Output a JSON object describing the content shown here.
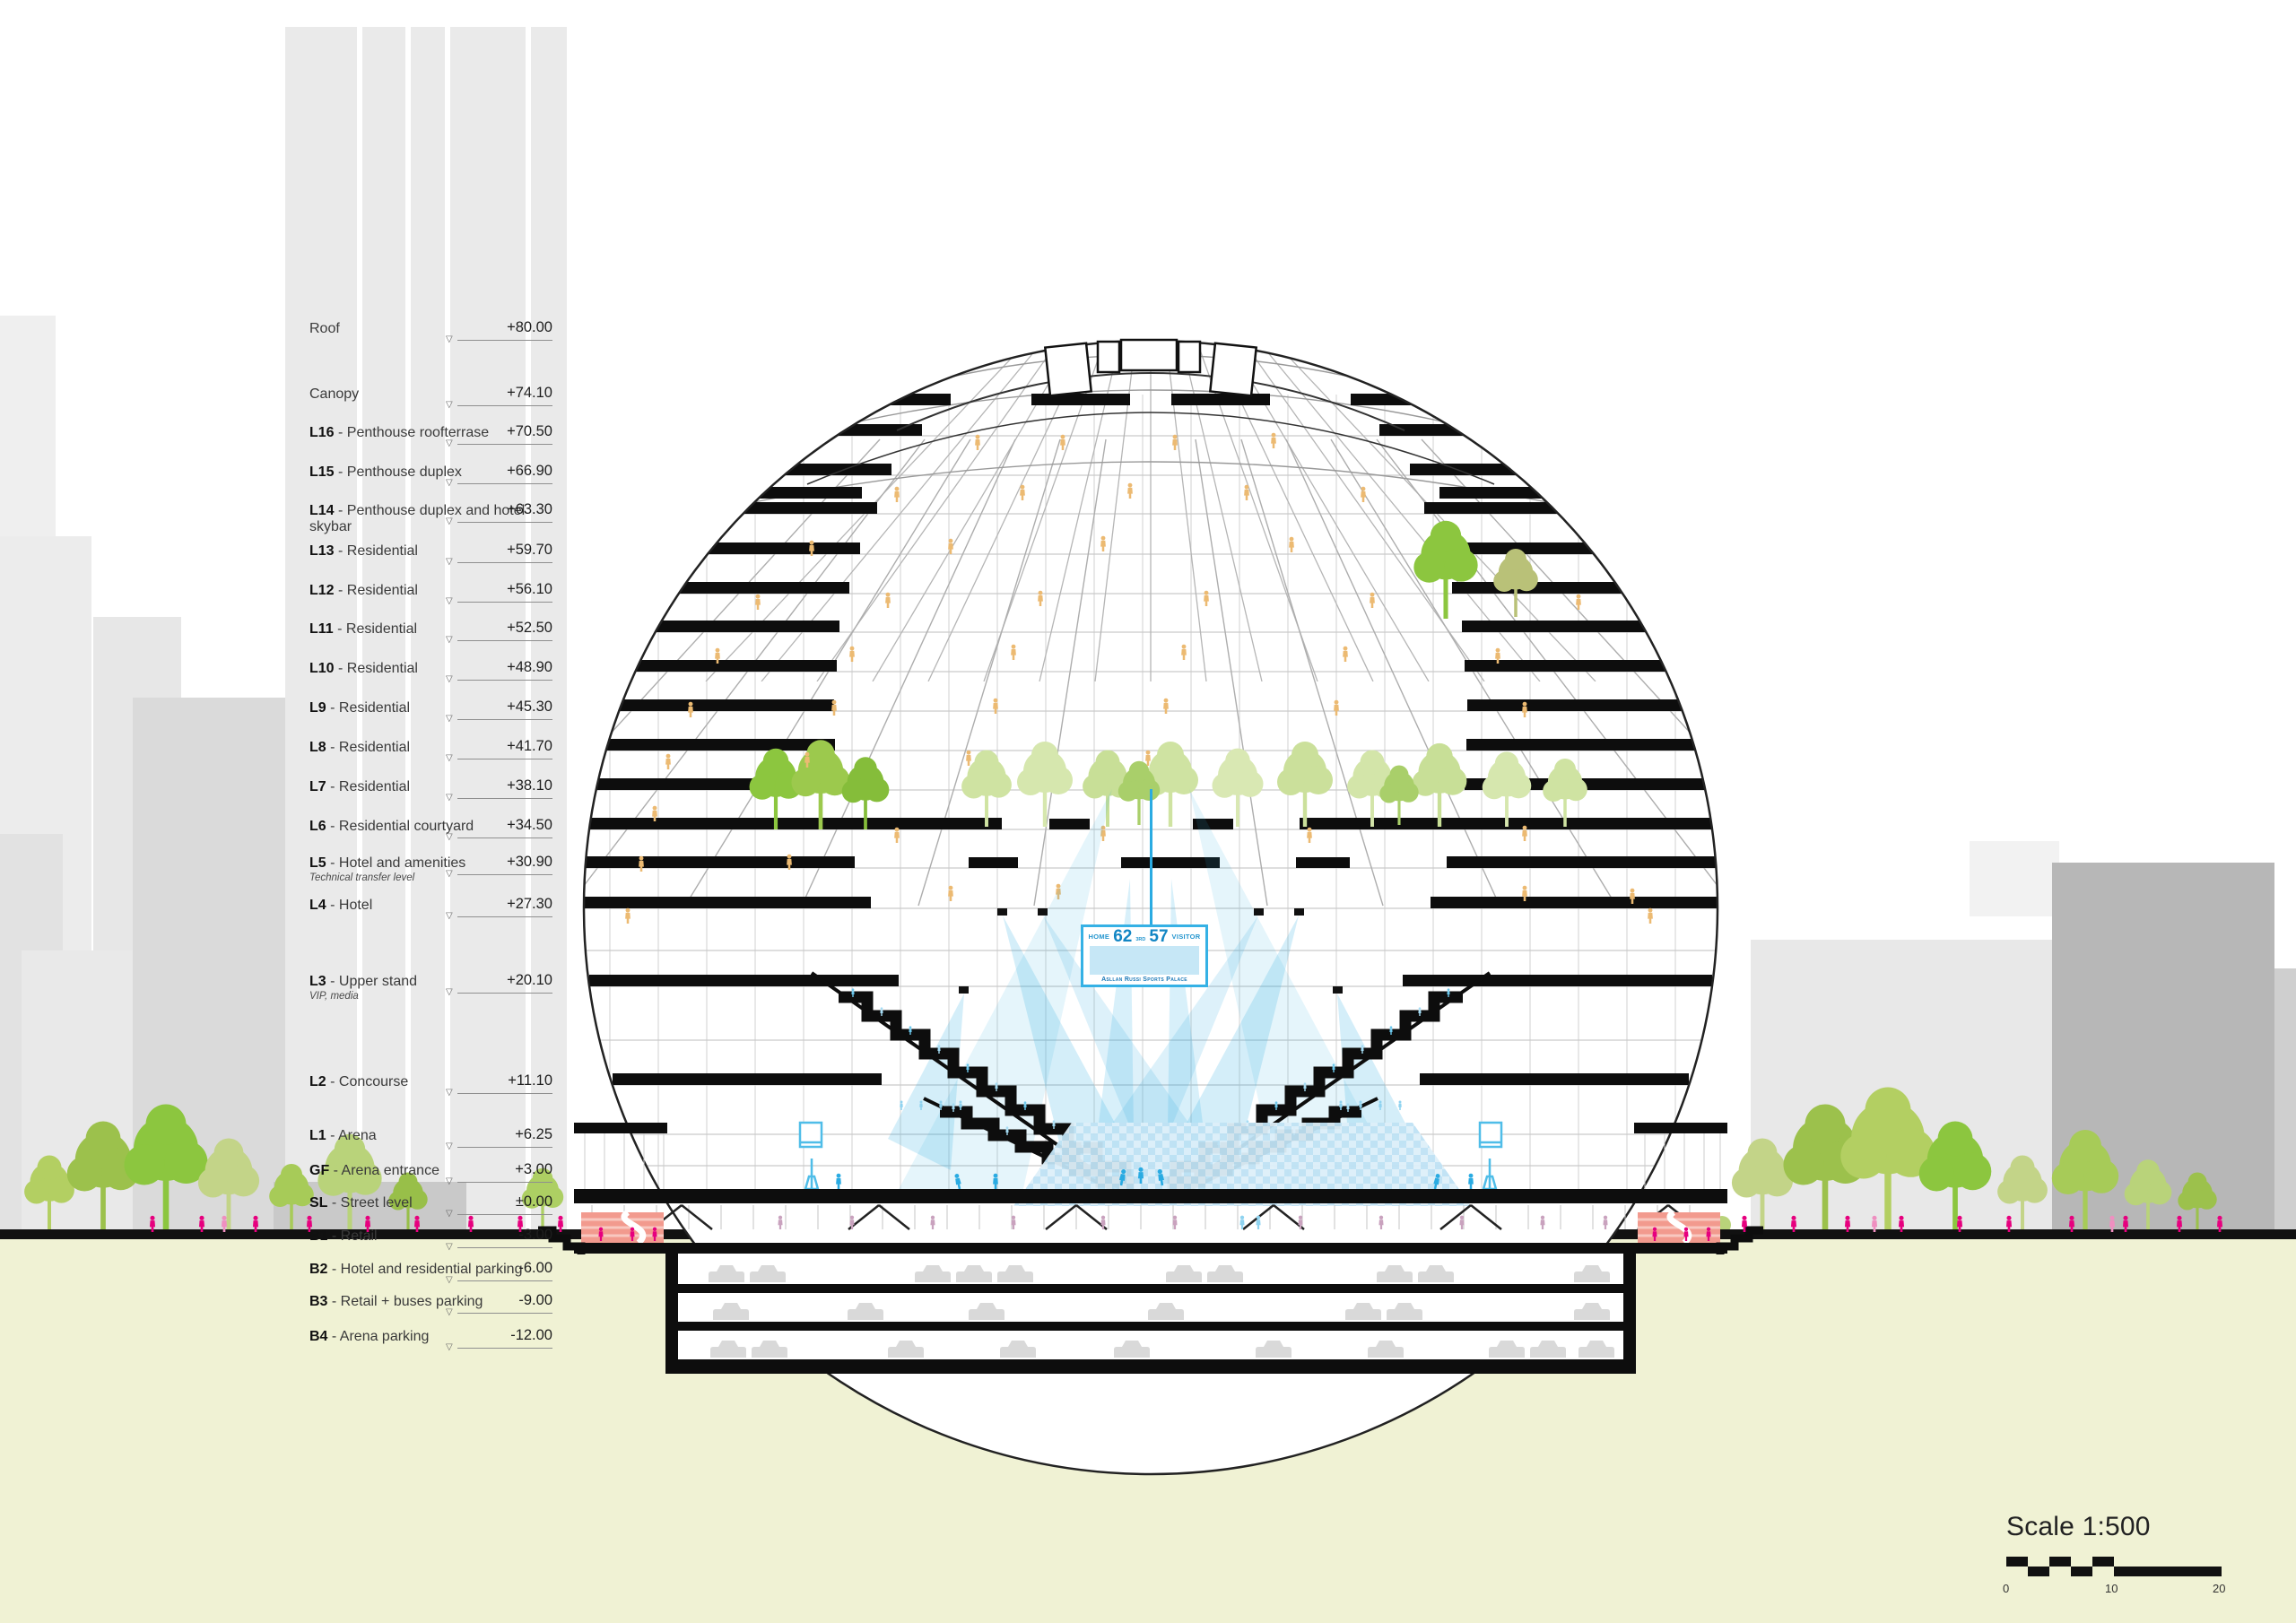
{
  "colors": {
    "accent_blue": "#29abe2",
    "score_blue": "#1386c4",
    "beam_blue": "#bfe4f4",
    "magenta": "#e6007e",
    "tan_people": "#ecba72",
    "tree_green": "#8cc63f",
    "pale_green": "#cfe3a2",
    "ground_yellow": "#f0f2d4",
    "building_gray": "#e9e9e9",
    "dark_building_gray": "#b7b7b7",
    "ramp_salmon": "#f29a8e"
  },
  "levels": [
    {
      "code": "",
      "name": "Roof",
      "value": "+80.00"
    },
    {
      "code": "",
      "name": "Canopy",
      "value": "+74.10"
    },
    {
      "code": "L16",
      "name": " - Penthouse roofterrase",
      "value": "+70.50"
    },
    {
      "code": "L15",
      "name": " - Penthouse duplex",
      "value": "+66.90"
    },
    {
      "code": "L14",
      "name": " - Penthouse duplex and hotel skybar",
      "value": "+63.30"
    },
    {
      "code": "L13",
      "name": " - Residential",
      "value": "+59.70"
    },
    {
      "code": "L12",
      "name": " - Residential",
      "value": "+56.10"
    },
    {
      "code": "L11",
      "name": " - Residential",
      "value": "+52.50"
    },
    {
      "code": "L10",
      "name": " - Residential",
      "value": "+48.90"
    },
    {
      "code": "L9",
      "name": " - Residential",
      "value": "+45.30"
    },
    {
      "code": "L8",
      "name": " - Residential",
      "value": "+41.70"
    },
    {
      "code": "L7",
      "name": " - Residential",
      "value": "+38.10"
    },
    {
      "code": "L6",
      "name": " - Residential courtyard",
      "value": "+34.50"
    },
    {
      "code": "L5",
      "name": " - Hotel and amenities",
      "sub": "Technical transfer level",
      "value": "+30.90"
    },
    {
      "code": "L4",
      "name": " - Hotel",
      "value": "+27.30"
    },
    {
      "code": "L3",
      "name": " - Upper stand",
      "sub": "VIP, media",
      "value": "+20.10"
    },
    {
      "code": "L2",
      "name": " - Concourse",
      "value": "+11.10"
    },
    {
      "code": "L1",
      "name": " - Arena",
      "value": "+6.25"
    },
    {
      "code": "GF",
      "name": " - Arena entrance",
      "value": "+3.00"
    },
    {
      "code": "SL",
      "name": " - Street level",
      "value": "±0.00"
    },
    {
      "code": "B1",
      "name": " - Retail",
      "value": "-3.00"
    },
    {
      "code": "B2",
      "name": " - Hotel and residential parking",
      "value": "-6.00"
    },
    {
      "code": "B3",
      "name": " - Retail + buses parking",
      "value": "-9.00"
    },
    {
      "code": "B4",
      "name": " - Arena parking",
      "value": "-12.00"
    }
  ],
  "scoreboard": {
    "home_label": "HOME",
    "home_score": "62",
    "period": "3RD",
    "visitor_score": "57",
    "visitor_label": "VISITOR",
    "venue": "Asllan Russi Sports Palace"
  },
  "scale_bar": {
    "label": "Scale 1:500",
    "tick_0": "0",
    "tick_10": "10",
    "tick_20": "20"
  }
}
